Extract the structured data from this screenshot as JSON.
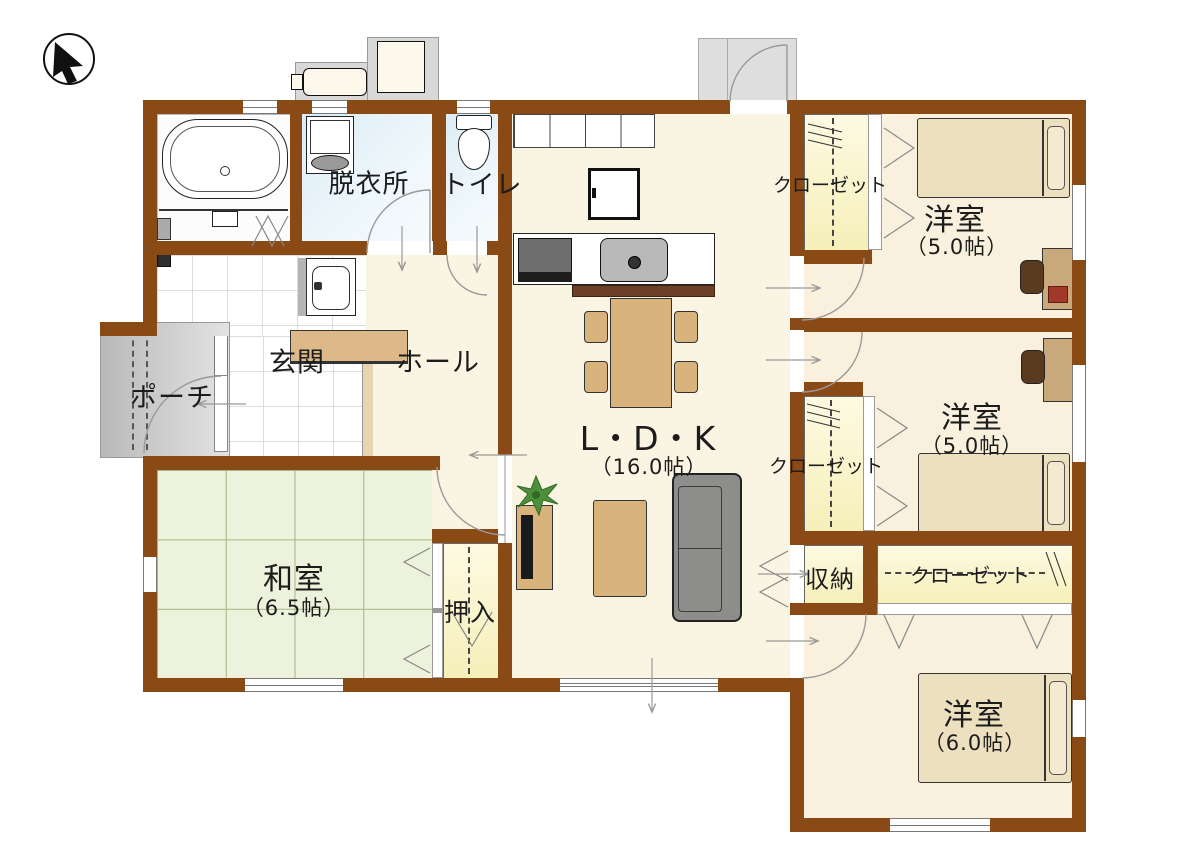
{
  "rooms": {
    "dressing": {
      "label": "脱衣所"
    },
    "toilet": {
      "label": "トイレ"
    },
    "entrance": {
      "label": "玄関"
    },
    "hall": {
      "label": "ホール"
    },
    "porch": {
      "label": "ポーチ"
    },
    "ldk": {
      "label": "L・D・K",
      "size": "（16.0帖）"
    },
    "washitsu": {
      "label": "和室",
      "size": "（6.5帖）"
    },
    "oshiire": {
      "label": "押入"
    },
    "storage": {
      "label": "収納"
    },
    "bedroom_ne": {
      "label": "洋室",
      "size": "（5.0帖）"
    },
    "bedroom_e": {
      "label": "洋室",
      "size": "（5.0帖）"
    },
    "bedroom_se": {
      "label": "洋室",
      "size": "（6.0帖）"
    }
  },
  "closets": {
    "ne": {
      "label": "クローゼット"
    },
    "e": {
      "label": "クローゼット"
    },
    "se": {
      "label": "クローゼット"
    }
  },
  "icons": {
    "compass": "north-arrow"
  },
  "colors": {
    "wall": "#8a4a16",
    "floor_wood": "#faf4e3",
    "tatami": "#edf2dc",
    "closet": "#f9f3c9",
    "wet_area": "#e3eff7",
    "furniture_wood": "#d9b37c",
    "sofa": "#8d8d8b",
    "bed": "#ece0bf"
  }
}
